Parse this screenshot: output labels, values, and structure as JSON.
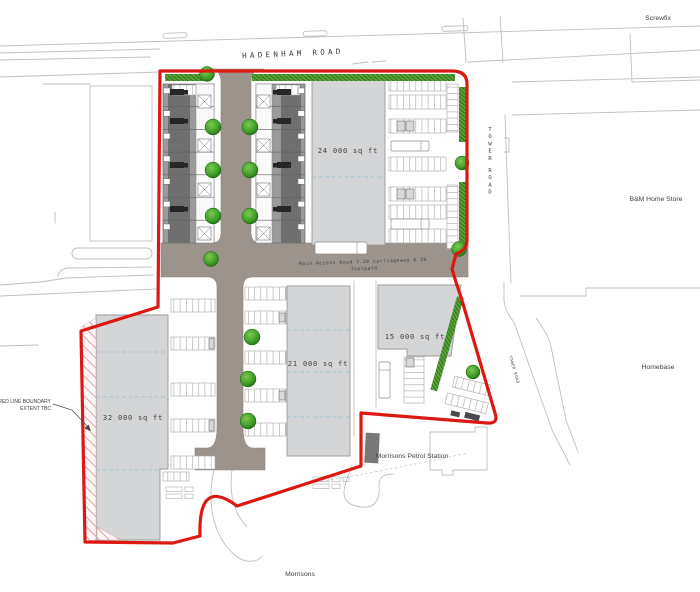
{
  "roads": {
    "hadenham": "HADENHAM ROAD",
    "tower_vertical": "TOWER ROAD",
    "tower_small": "TOWER ROAD",
    "access_note_line1": "Main Access Road 7.2m carriageway & 2m",
    "access_note_line2": "footpath"
  },
  "context_labels": {
    "screwfix": "Screwfix",
    "bm_home_store": "B&M Home Store",
    "homebase": "Homebase",
    "morrisons": "Morrisons",
    "petrol_station": "Morrisons Petrol Station"
  },
  "buildings": {
    "unit_ne": "24 000 sq ft",
    "unit_s": "21 000 sq ft",
    "unit_se": "15 000 sq ft",
    "unit_w": "32 000 sq ft"
  },
  "annotations": {
    "boundary_note_line1": "RED LINE BOUNDARY",
    "boundary_note_line2": "EXTENT TBC"
  },
  "colors": {
    "boundary_red": "#dc1812",
    "road_surface": "#9c948c",
    "building_fill": "#d4d5d7",
    "terrace_dark": "#6f6f6f",
    "tree_green": "#3f9e28",
    "hedge_green": "#5aa33a",
    "gridline_cyan": "#9fc8d2",
    "hatch_pink": "#e4a0a0"
  }
}
